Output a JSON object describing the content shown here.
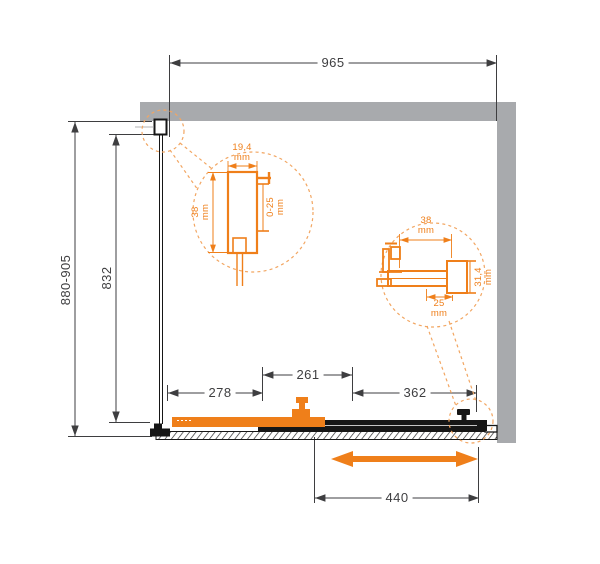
{
  "diagram_type": "shower-enclosure-plan-drawing",
  "colors": {
    "accent_orange": "#ef7f1a",
    "accent_orange_light": "#f2a662",
    "wall_gray": "#a8aaad",
    "line_dark": "#3e3e40",
    "structure_black": "#161616"
  },
  "dims": {
    "width": {
      "value": "965"
    },
    "depth_range": {
      "value": "880-905"
    },
    "glass_depth": {
      "value": "832"
    },
    "segment_left": {
      "value": "278"
    },
    "segment_middle": {
      "value": "261"
    },
    "segment_right": {
      "value": "362"
    },
    "door_travel": {
      "value": "440"
    }
  },
  "detail_wall_profile": {
    "width_value": "19,4",
    "width_unit": "mm",
    "depth_value": "38",
    "depth_unit": "mm",
    "adjust_value": "0-25",
    "adjust_unit": "mm"
  },
  "detail_roller": {
    "width_value": "38",
    "width_unit": "mm",
    "bottom_value": "25",
    "bottom_unit": "mm",
    "height_value": "31,4",
    "height_unit": "mm"
  }
}
